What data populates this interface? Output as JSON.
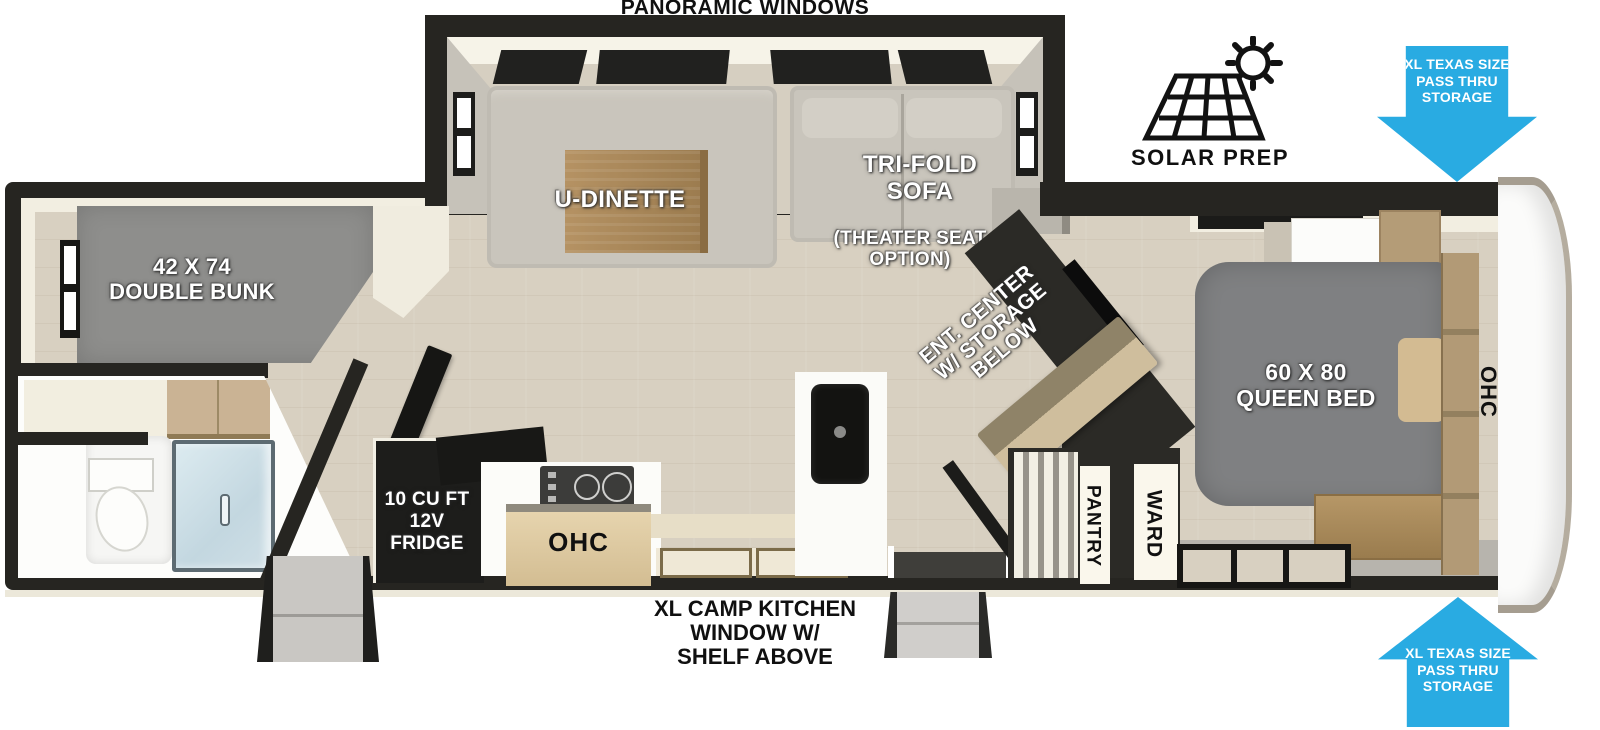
{
  "labels": {
    "panoramic_windows": "PANORAMIC WINDOWS",
    "solar_prep": "SOLAR PREP",
    "pass_thru_top": "XL TEXAS SIZE\nPASS THRU\nSTORAGE",
    "pass_thru_bottom": "XL TEXAS SIZE\nPASS THRU\nSTORAGE",
    "camp_kitchen": "XL CAMP KITCHEN\nWINDOW W/\nSHELF ABOVE",
    "u_dinette": "U-DINETTE",
    "tri_fold_sofa": "TRI-FOLD\nSOFA",
    "theater_seat_option": "(THEATER SEAT\nOPTION)",
    "double_bunk": "42 X 74\nDOUBLE BUNK",
    "ent_center": "ENT. CENTER\nW/ STORAGE\nBELOW",
    "queen_bed": "60 X 80\nQUEEN BED",
    "fridge": "10 CU FT\n12V\nFRIDGE",
    "ohc_kitchen": "OHC",
    "ohc_bedroom": "OHC",
    "pantry": "PANTRY",
    "ward": "WARD"
  },
  "icons": {
    "solar_prep_icon": "solar-panel-with-sun",
    "pass_thru_top_icon": "arrow-down",
    "pass_thru_bottom_icon": "arrow-up"
  },
  "colors": {
    "arrow_blue": "#29ABE2",
    "wall_black": "#262521",
    "floor_beige": "#d8d0c1",
    "mattress_gray": "#7f8082",
    "bunk_gray": "#8e8e8c",
    "sofa_greige": "#c9c5bc",
    "wood_tan": "#ab8c5f",
    "cabinet_tan": "#d8c49c",
    "shower_blue": "#cfdfe6"
  }
}
